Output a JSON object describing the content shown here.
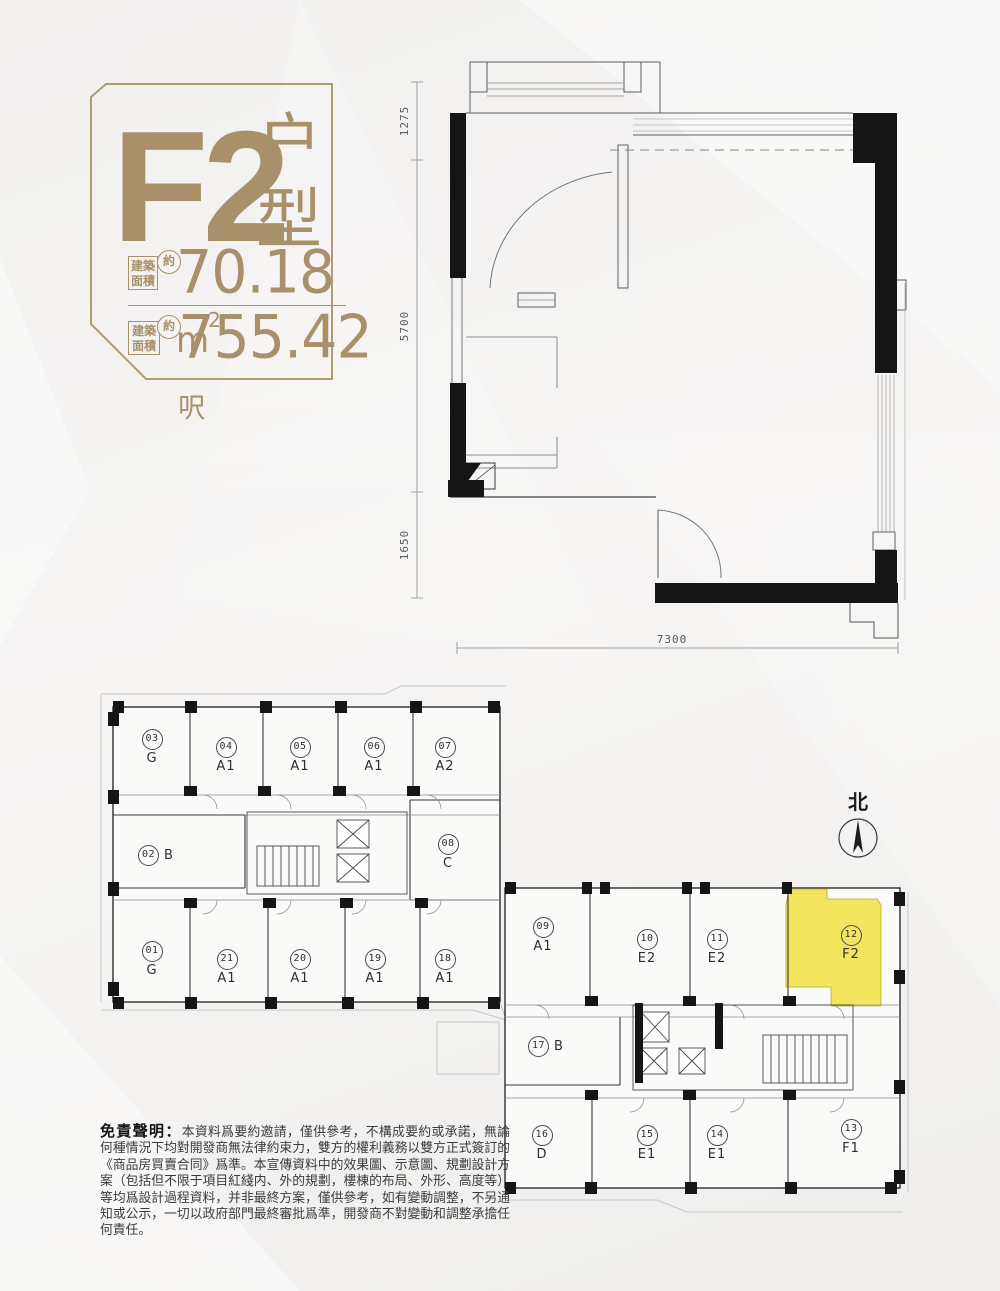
{
  "colors": {
    "accent_gold": "#a8916a",
    "highlight_yellow": "#f3e55d",
    "wall_black": "#151515"
  },
  "emblem": {
    "unit_code": "F2",
    "unit_type_label": "户型",
    "rows": [
      {
        "label_line1": "建築",
        "label_line2": "面積",
        "approx": "約",
        "value": "70.18",
        "unit": "m",
        "sup": "2"
      },
      {
        "label_line1": "建築",
        "label_line2": "面積",
        "approx": "約",
        "value": "755.42",
        "unit": "呎",
        "sup": ""
      }
    ]
  },
  "main_plan": {
    "dims": {
      "left_top": "1275",
      "left_middle": "5700",
      "left_bottom": "1650",
      "bottom": "7300"
    }
  },
  "plate": {
    "north_label": "北",
    "highlight_unit": "u12",
    "units": {
      "u01": {
        "no": "01",
        "type": "G"
      },
      "u02": {
        "no": "02",
        "type": "B"
      },
      "u03": {
        "no": "03",
        "type": "G"
      },
      "u04": {
        "no": "04",
        "type": "A1"
      },
      "u05": {
        "no": "05",
        "type": "A1"
      },
      "u06": {
        "no": "06",
        "type": "A1"
      },
      "u07": {
        "no": "07",
        "type": "A2"
      },
      "u08": {
        "no": "08",
        "type": "C"
      },
      "u09": {
        "no": "09",
        "type": "A1"
      },
      "u10": {
        "no": "10",
        "type": "E2"
      },
      "u11": {
        "no": "11",
        "type": "E2"
      },
      "u12": {
        "no": "12",
        "type": "F2"
      },
      "u13": {
        "no": "13",
        "type": "F1"
      },
      "u14": {
        "no": "14",
        "type": "E1"
      },
      "u15": {
        "no": "15",
        "type": "E1"
      },
      "u16": {
        "no": "16",
        "type": "D"
      },
      "u17": {
        "no": "17",
        "type": "B"
      },
      "u18": {
        "no": "18",
        "type": "A1"
      },
      "u19": {
        "no": "19",
        "type": "A1"
      },
      "u20": {
        "no": "20",
        "type": "A1"
      },
      "u21": {
        "no": "21",
        "type": "A1"
      }
    }
  },
  "disclaimer": {
    "heading": "免責聲明：",
    "body": "本資料爲要約邀請，僅供參考，不構成要約或承諾，無論何種情況下均對開發商無法律約束力，雙方的權利義務以雙方正式簽訂的《商品房買賣合同》爲準。本宣傳資料中的效果圖、示意圖、規劃設計方案（包括但不限于項目紅綫内、外的規劃，樓棟的布局、外形、高度等）等均爲設計過程資料，并非最終方案，僅供參考，如有變動調整，不另通知或公示，一切以政府部門最終審批爲準，開發商不對變動和調整承擔任何責任。"
  }
}
